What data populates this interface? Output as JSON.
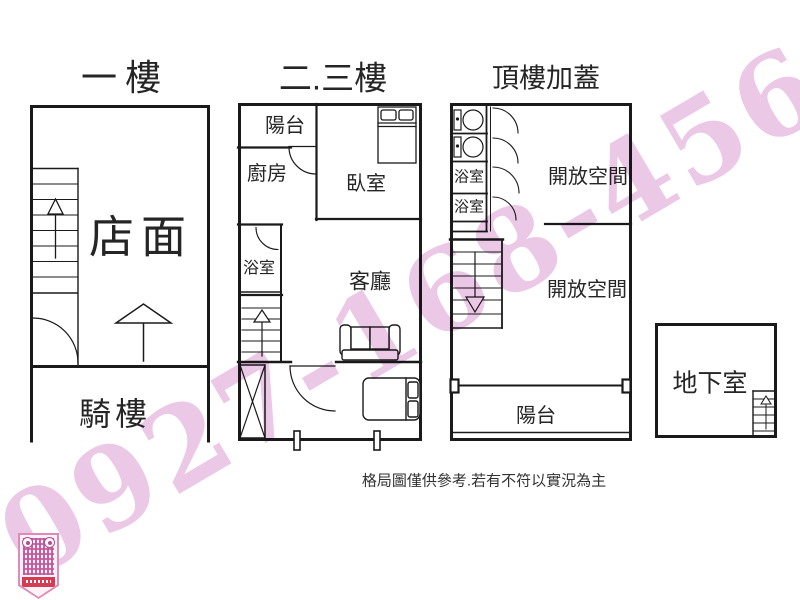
{
  "watermark": {
    "text": "0927-168-456",
    "color": "#d27cc6"
  },
  "titles": {
    "floor1": "一樓",
    "floor2": "二.三樓",
    "floor3": "頂樓加蓋"
  },
  "floor1": {
    "shop": "店面",
    "arcade": "騎樓"
  },
  "floor2": {
    "balcony": "陽台",
    "kitchen": "廚房",
    "bedroom": "臥室",
    "bathroom": "浴室",
    "living": "客廳"
  },
  "floor3": {
    "bathroom1": "浴室",
    "bathroom2": "浴室",
    "open_space_upper": "開放空間",
    "open_space_lower": "開放空間",
    "balcony": "陽台"
  },
  "basement": {
    "label": "地下室"
  },
  "footer": {
    "disclaimer": "格局圖僅供參考.若有不符以實況為主"
  },
  "icons": {
    "qr": "qr-code-icon",
    "stairs_up": "stairs-up-arrow",
    "stairs_down": "stairs-down-arrow",
    "entrance": "entrance-arrow"
  },
  "colors": {
    "wall": "#1a1a1a",
    "watermark_pink": "#d27cc6",
    "qr_magenta": "#c2579c",
    "qr_banner_red": "#d63b52"
  }
}
